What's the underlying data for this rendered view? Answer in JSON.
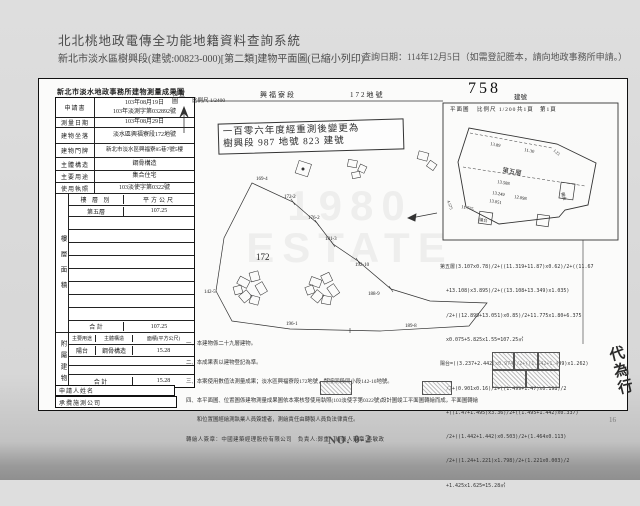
{
  "page": {
    "system_title": "北北桃地政電傳全功能地籍資料查詢系統",
    "doc_subtitle": "新北市淡水區樹興段(建號:00823-000)[第二類]建物平面圖(已縮小列印)",
    "query_date": "查詢日期：114年12月5日（如需登記謄本，請向地政事務所申請。）",
    "bottom_mark": "NO. 0-2",
    "bottom_page_mark": "16"
  },
  "survey_table": {
    "title": "新北市淡水地政事務所建物測量成果圖",
    "info_rows": [
      {
        "label": "申請書",
        "value": "103年08月19日\n103年淡測字第032892號"
      },
      {
        "label": "測量日期",
        "value": "103年08月29日"
      },
      {
        "label": "建物坐落",
        "value": "淡水區興福寮段172地號"
      },
      {
        "label": "建物門牌",
        "value": "新北市淡水區興福寮85巷7號5樓"
      },
      {
        "label": "主體構造",
        "value": "鋼骨構造"
      },
      {
        "label": "主要用途",
        "value": "集合住宅"
      },
      {
        "label": "使用執照",
        "value": "103淡使字第0322號"
      }
    ],
    "floor_section": {
      "side_label": "樓層面積",
      "col1": "樓 層 別",
      "col2": "平方公尺",
      "floor": "第五層",
      "floor_area": "107.25",
      "total_label": "合  計",
      "total": "107.25"
    },
    "annex_section": {
      "side_label": "附屬建物",
      "col1": "主要用途",
      "col2": "主體構造",
      "col3": "面積(平方公尺)",
      "use": "陽台",
      "structure": "鋼骨構造",
      "area": "15.28",
      "total_label": "合  計",
      "total": "15.28"
    },
    "applicant_label": "申請人姓名",
    "surveyor_label": "承攬施測公司"
  },
  "map": {
    "section_name": "興福寮段",
    "parcel_no": "172地號",
    "building_no": "758",
    "building_no_suffix": "建號",
    "plan_label": "平面圖",
    "plan_scale": "比例尺 1/200",
    "pages_total": "共1頁",
    "page_no": "第1頁",
    "loc_label": "位置圖",
    "loc_scale": "比例尺 1/2400",
    "remeasure_line1": "一百零六年度經重測後變更為",
    "remeasure_line2": "樹興段 987 地號 823 建號",
    "parcels": {
      "main": "172",
      "p1": "169-4",
      "p2": "172-2",
      "p3": "176-2",
      "p4": "181-3",
      "p5": "192-10",
      "p6": "188-9",
      "p7": "189-8",
      "p8": "196-1",
      "p9": "142-5"
    },
    "plan": {
      "floor": "第五層",
      "d1": "13.89",
      "d2": "11.30",
      "d3": "13.588",
      "d4": "13.249",
      "d5": "12.098",
      "d6": "13.051",
      "d7": "11.775",
      "d8": "4.575",
      "d9": "1.23",
      "balcony1": "陽台",
      "balcony2": "陽台"
    }
  },
  "formulas": {
    "lines": [
      "第五層(3.107x0.78)/2+((11.319+11.87)x0.62)/2+((11.67",
      "  +13.108)x3.895)/2+((13.108+13.349)x1.035)",
      "  /2+((12.899+13.051)x0.85)/2+11.775x1.80+6.375",
      "  x0.075+5.825x1.55=107.25㎡",
      "陽台=((3.237+2.442)x0.974)/2+((1.542+1.499)x1.262)",
      "  /2+(0.901x0.16)/2+((1.499+1.47)x0.198)/2",
      "  +((1.47+1.495)x3.36)/2+((1.495+1.442)x0.337)",
      "  /2+((1.442+1.442)x0.503)/2+(1.464x0.113)",
      "  /2+((1.24+1.221)x1.798)/2+(1.221x0.003)/2",
      "  +1.425x1.625=15.28㎡"
    ]
  },
  "notes": {
    "lines": [
      "一、本建物係二十九層建物。",
      "二、本成果表以建物登記為準。",
      "三、本案使用數值法測量成果；淡水區興福寮段172地號，鄰接同段同小段142-10地號。",
      "四、本平面圖、位置圖係建物測量成果圖依本案核發使用執照(103淡使字第0322號)設計圖竣工平面圖轉繪而成，平面圖轉繪",
      "　　和位置圖經繪測執業人員簽證者，測繪責任由轉製人員負法律責任。"
    ],
    "signature": "轉繪人簽章：中國建築經理股份有限公司　負責人:鄭重　繪製人簽章:吳敏政"
  },
  "stamps": {
    "big_seal": "代為行"
  },
  "watermark": {
    "line1": "1980",
    "line2": "ESTATE"
  }
}
